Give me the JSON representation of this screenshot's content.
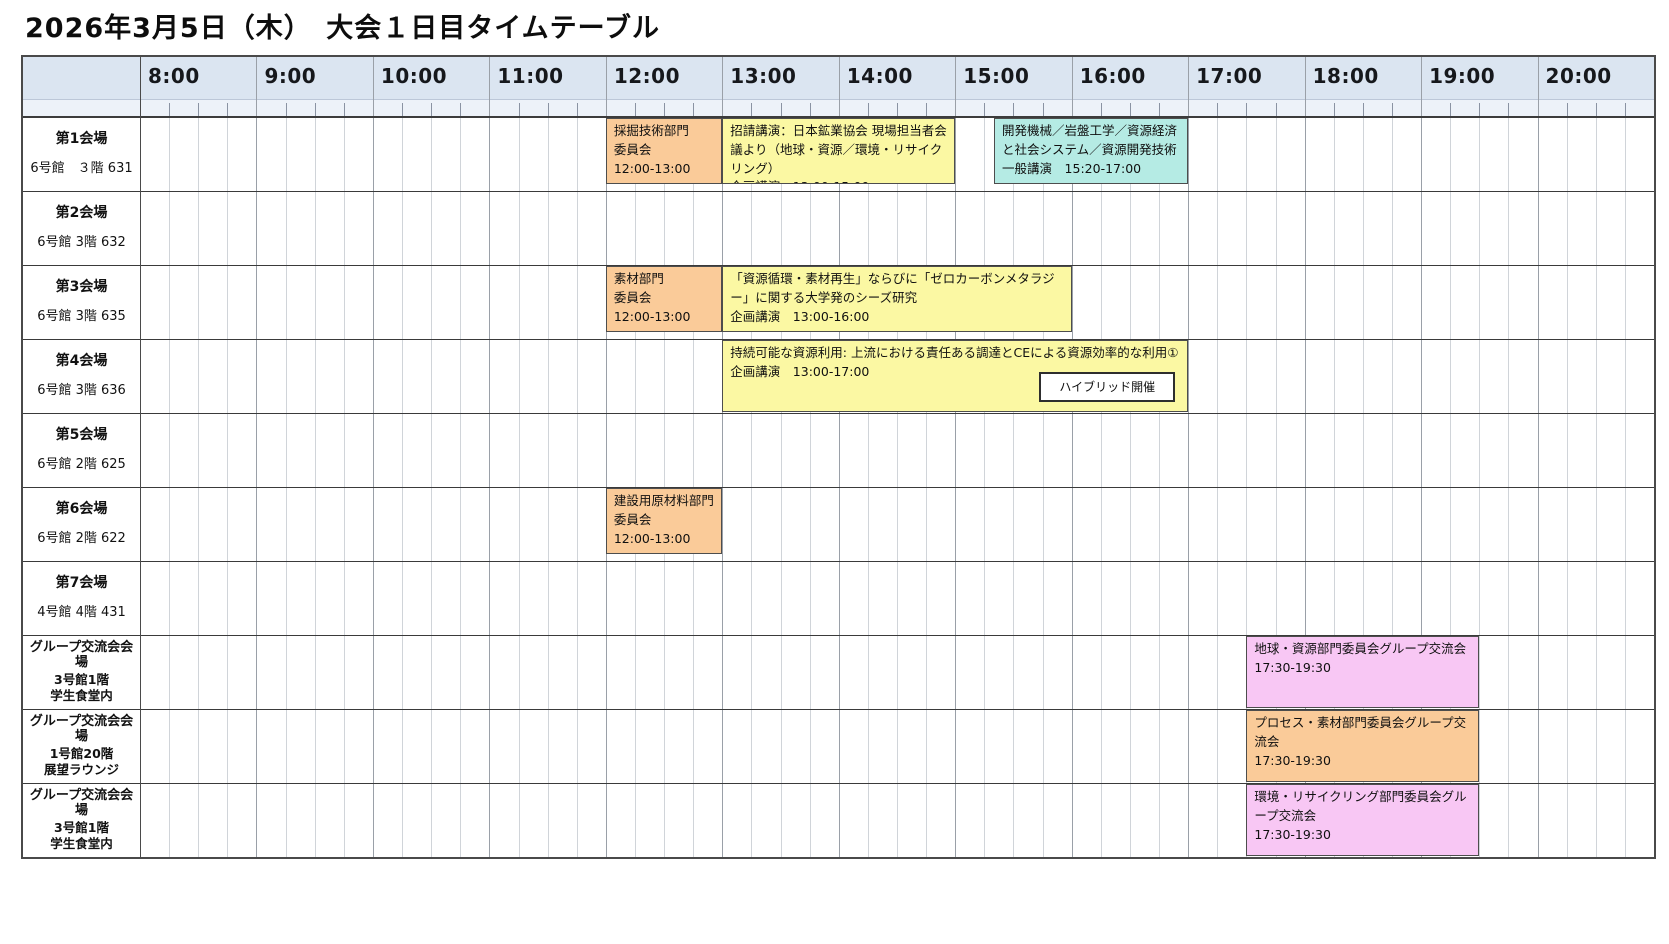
{
  "title": "2026年3月5日（木）　大会１日目タイムテーブル",
  "header": {
    "hours": [
      "8:00",
      "9:00",
      "10:00",
      "11:00",
      "12:00",
      "13:00",
      "14:00",
      "15:00",
      "16:00",
      "17:00",
      "18:00",
      "19:00",
      "20:00"
    ],
    "start_hour": 8,
    "end_hour": 21,
    "minor_interval_minutes": 15
  },
  "colors": {
    "header_bg": "#DBE5F1",
    "tickstrip_bg": "#EDF2F9",
    "committee_orange": "#FACB99",
    "seminar_yellow": "#FBF8A3",
    "general_cyan": "#B5EBE4",
    "social_pink": "#F8C7F4",
    "grid_hour": "#9AA0A8",
    "grid_quarter": "#D0D4D9",
    "row_line": "#3A3A3A",
    "border": "#4A4A4A"
  },
  "rows": [
    {
      "type": "venue",
      "name": "第1会場",
      "location": [
        "6号館　３階 631"
      ],
      "events": [
        {
          "lines": [
            "採掘技術部門",
            "委員会",
            "12:00-13:00"
          ],
          "start": 12,
          "end": 13,
          "color": "committee_orange",
          "full_height": false
        },
        {
          "lines": [
            "招請講演：日本鉱業協会 現場担当者会議より（地球・資源／環境・リサイクリング）",
            "企画講演　13:00-15:00"
          ],
          "start": 13,
          "end": 15,
          "color": "seminar_yellow",
          "full_height": false
        },
        {
          "lines": [
            "開発機械／岩盤工学／資源経済と社会システム／資源開発技術",
            "一般講演　15:20-17:00"
          ],
          "start": 15.3333,
          "end": 17,
          "color": "general_cyan",
          "full_height": false
        }
      ]
    },
    {
      "type": "venue",
      "name": "第2会場",
      "location": [
        "6号館 3階 632"
      ],
      "events": []
    },
    {
      "type": "venue",
      "name": "第3会場",
      "location": [
        "6号館 3階 635"
      ],
      "events": [
        {
          "lines": [
            "素材部門",
            "委員会",
            "12:00-13:00"
          ],
          "start": 12,
          "end": 13,
          "color": "committee_orange",
          "full_height": false
        },
        {
          "lines": [
            "「資源循環・素材再生」ならびに「ゼロカーボンメタラジー」に関する大学発のシーズ研究",
            "企画講演　13:00-16:00"
          ],
          "start": 13,
          "end": 16,
          "color": "seminar_yellow",
          "full_height": false
        }
      ]
    },
    {
      "type": "venue",
      "name": "第4会場",
      "location": [
        "6号館 3階 636"
      ],
      "events": [
        {
          "lines": [
            "持続可能な資源利用: 上流における責任ある調達とCEによる資源効率的な利用①",
            "企画講演　13:00-17:00"
          ],
          "start": 13,
          "end": 17,
          "color": "seminar_yellow",
          "full_height": true,
          "badge": "ハイブリッド開催"
        }
      ]
    },
    {
      "type": "venue",
      "name": "第5会場",
      "location": [
        "6号館 2階 625"
      ],
      "events": []
    },
    {
      "type": "venue",
      "name": "第6会場",
      "location": [
        "6号館 2階 622"
      ],
      "events": [
        {
          "lines": [
            "建設用原材料部門",
            "委員会",
            "12:00-13:00"
          ],
          "start": 12,
          "end": 13,
          "color": "committee_orange",
          "full_height": false
        }
      ]
    },
    {
      "type": "venue",
      "name": "第7会場",
      "location": [
        "4号館 4階 431"
      ],
      "events": []
    },
    {
      "type": "social",
      "name": "グループ交流会会場",
      "location": [
        "3号館1階",
        "学生食堂内"
      ],
      "events": [
        {
          "lines": [
            "地球・資源部門委員会グループ交流会",
            "17:30-19:30"
          ],
          "start": 17.5,
          "end": 19.5,
          "color": "social_pink",
          "full_height": true
        }
      ]
    },
    {
      "type": "social",
      "name": "グループ交流会会場",
      "location": [
        "1号館20階",
        "展望ラウンジ"
      ],
      "events": [
        {
          "lines": [
            "プロセス・素材部門委員会グループ交流会",
            "17:30-19:30"
          ],
          "start": 17.5,
          "end": 19.5,
          "color": "committee_orange",
          "full_height": true
        }
      ]
    },
    {
      "type": "social",
      "name": "グループ交流会会場",
      "location": [
        "3号館1階",
        "学生食堂内"
      ],
      "events": [
        {
          "lines": [
            "環境・リサイクリング部門委員会グループ交流会",
            "17:30-19:30"
          ],
          "start": 17.5,
          "end": 19.5,
          "color": "social_pink",
          "full_height": true
        }
      ]
    }
  ]
}
